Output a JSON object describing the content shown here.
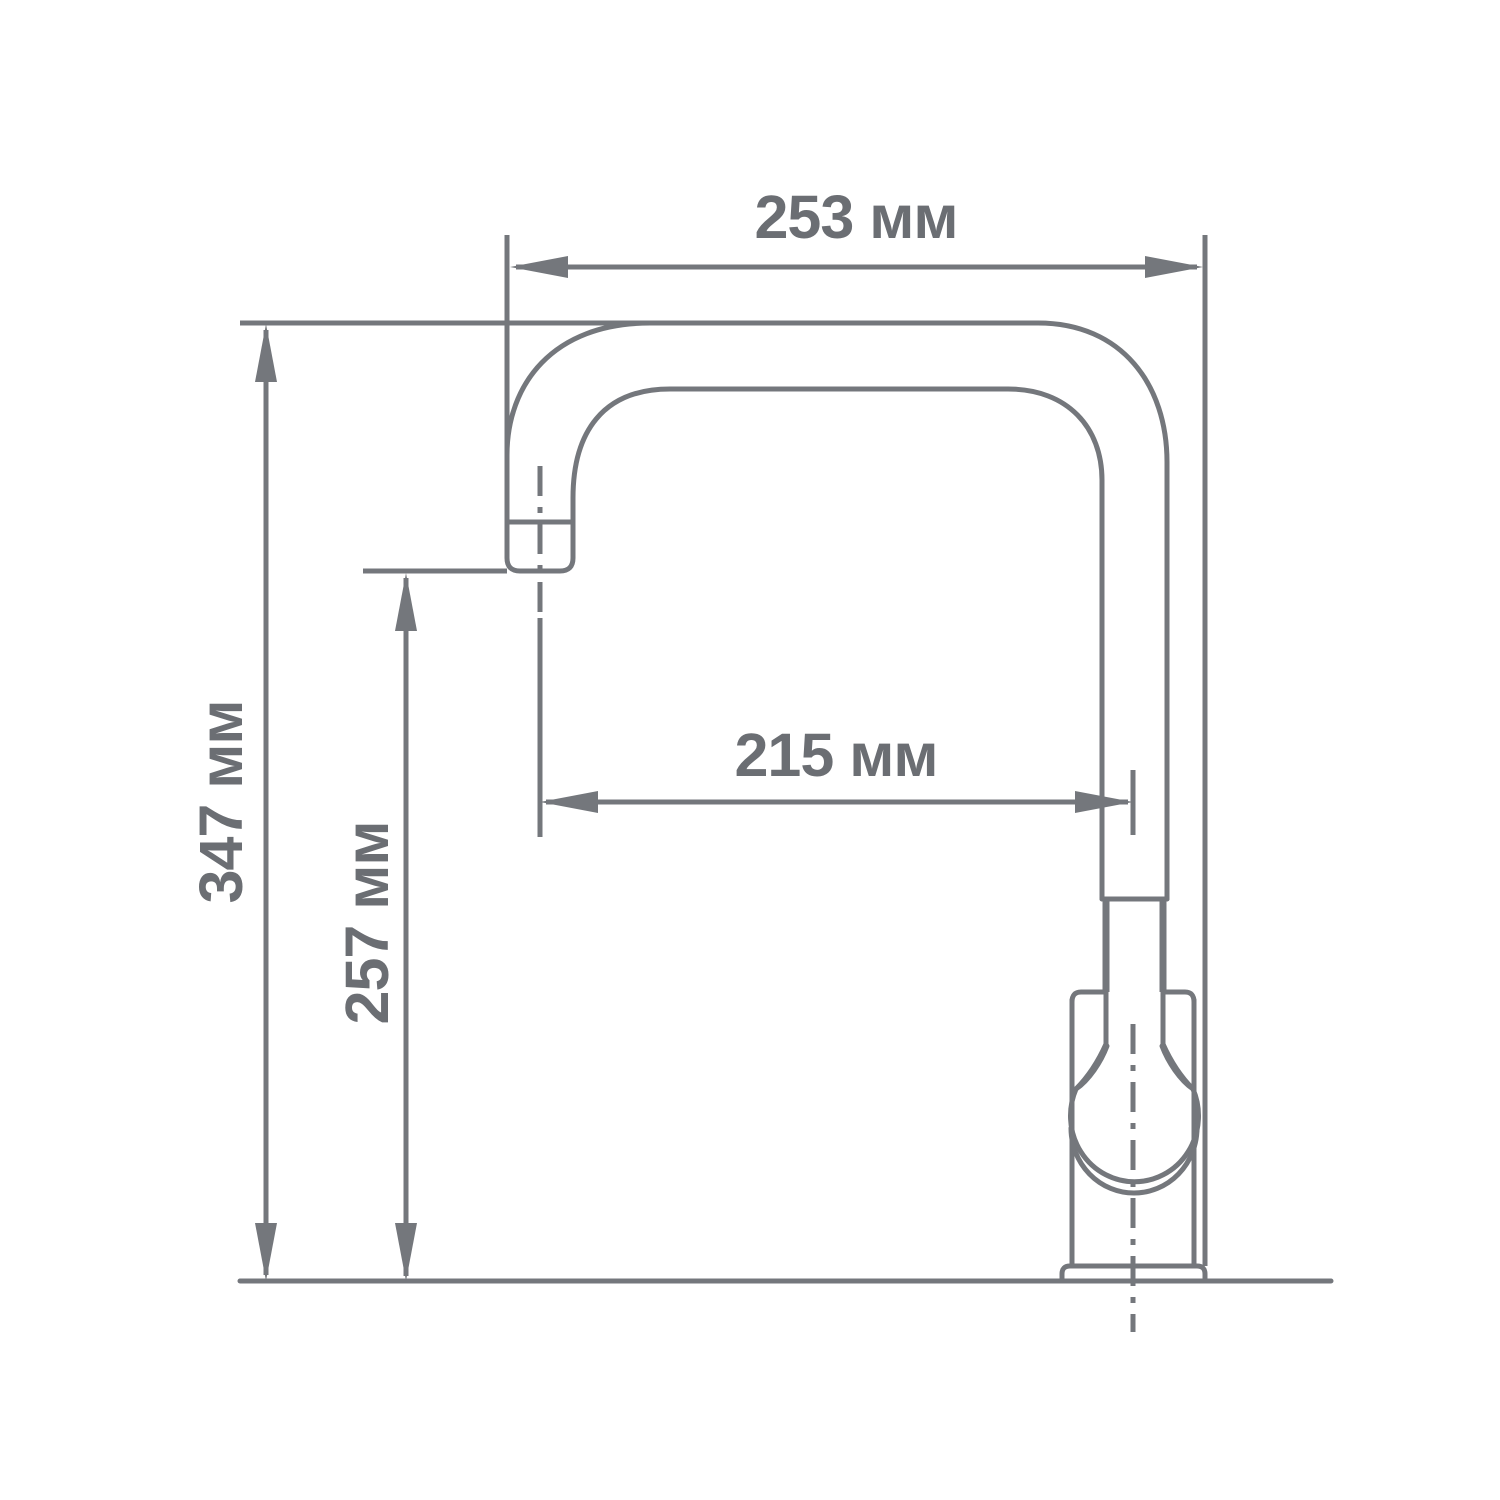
{
  "drawing": {
    "type": "technical-dimension-diagram",
    "units": "мм",
    "line_color": "#74777c",
    "text_color": "#6b6e73",
    "background_color": "#ffffff",
    "dimensions": {
      "overall_depth": {
        "label": "253 мм",
        "value": 253
      },
      "overall_height": {
        "label": "347 мм",
        "value": 347
      },
      "spout_height": {
        "label": "257 мм",
        "value": 257
      },
      "spout_reach": {
        "label": "215 мм",
        "value": 215
      }
    }
  }
}
